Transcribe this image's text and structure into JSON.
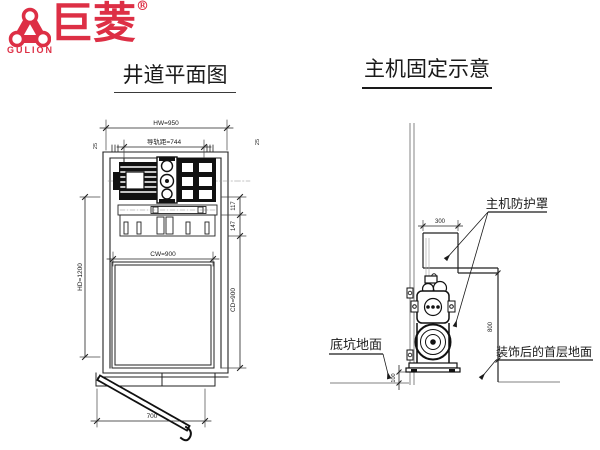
{
  "logo": {
    "name_cn": "巨菱",
    "registered": "®",
    "name_en": "GULION",
    "brand_color": "#dd2f45"
  },
  "titles": {
    "plan": "井道平面图",
    "elevation": "主机固定示意"
  },
  "plan_view": {
    "dimensions": {
      "hoistway_width": "HW=950",
      "rail_gauge": "导轨距=744",
      "rail_offset_left": "25",
      "rail_offset_right": "25",
      "machine_depth": "117",
      "bedplate_depth": "147",
      "hoistway_depth": "HD=1200",
      "car_width": "CW=900",
      "car_depth": "CD=900",
      "door_width": "700"
    }
  },
  "elevation_view": {
    "dimensions": {
      "cover_width": "300",
      "cover_height": "800",
      "base_height": "100"
    },
    "labels": {
      "machine_cover": "主机防护罩",
      "pit_floor": "底坑地面",
      "first_floor": "装饰后的首层地面"
    }
  },
  "colors": {
    "line": "#1a1a1a",
    "aux": "#999999",
    "brand": "#dd2f45"
  }
}
